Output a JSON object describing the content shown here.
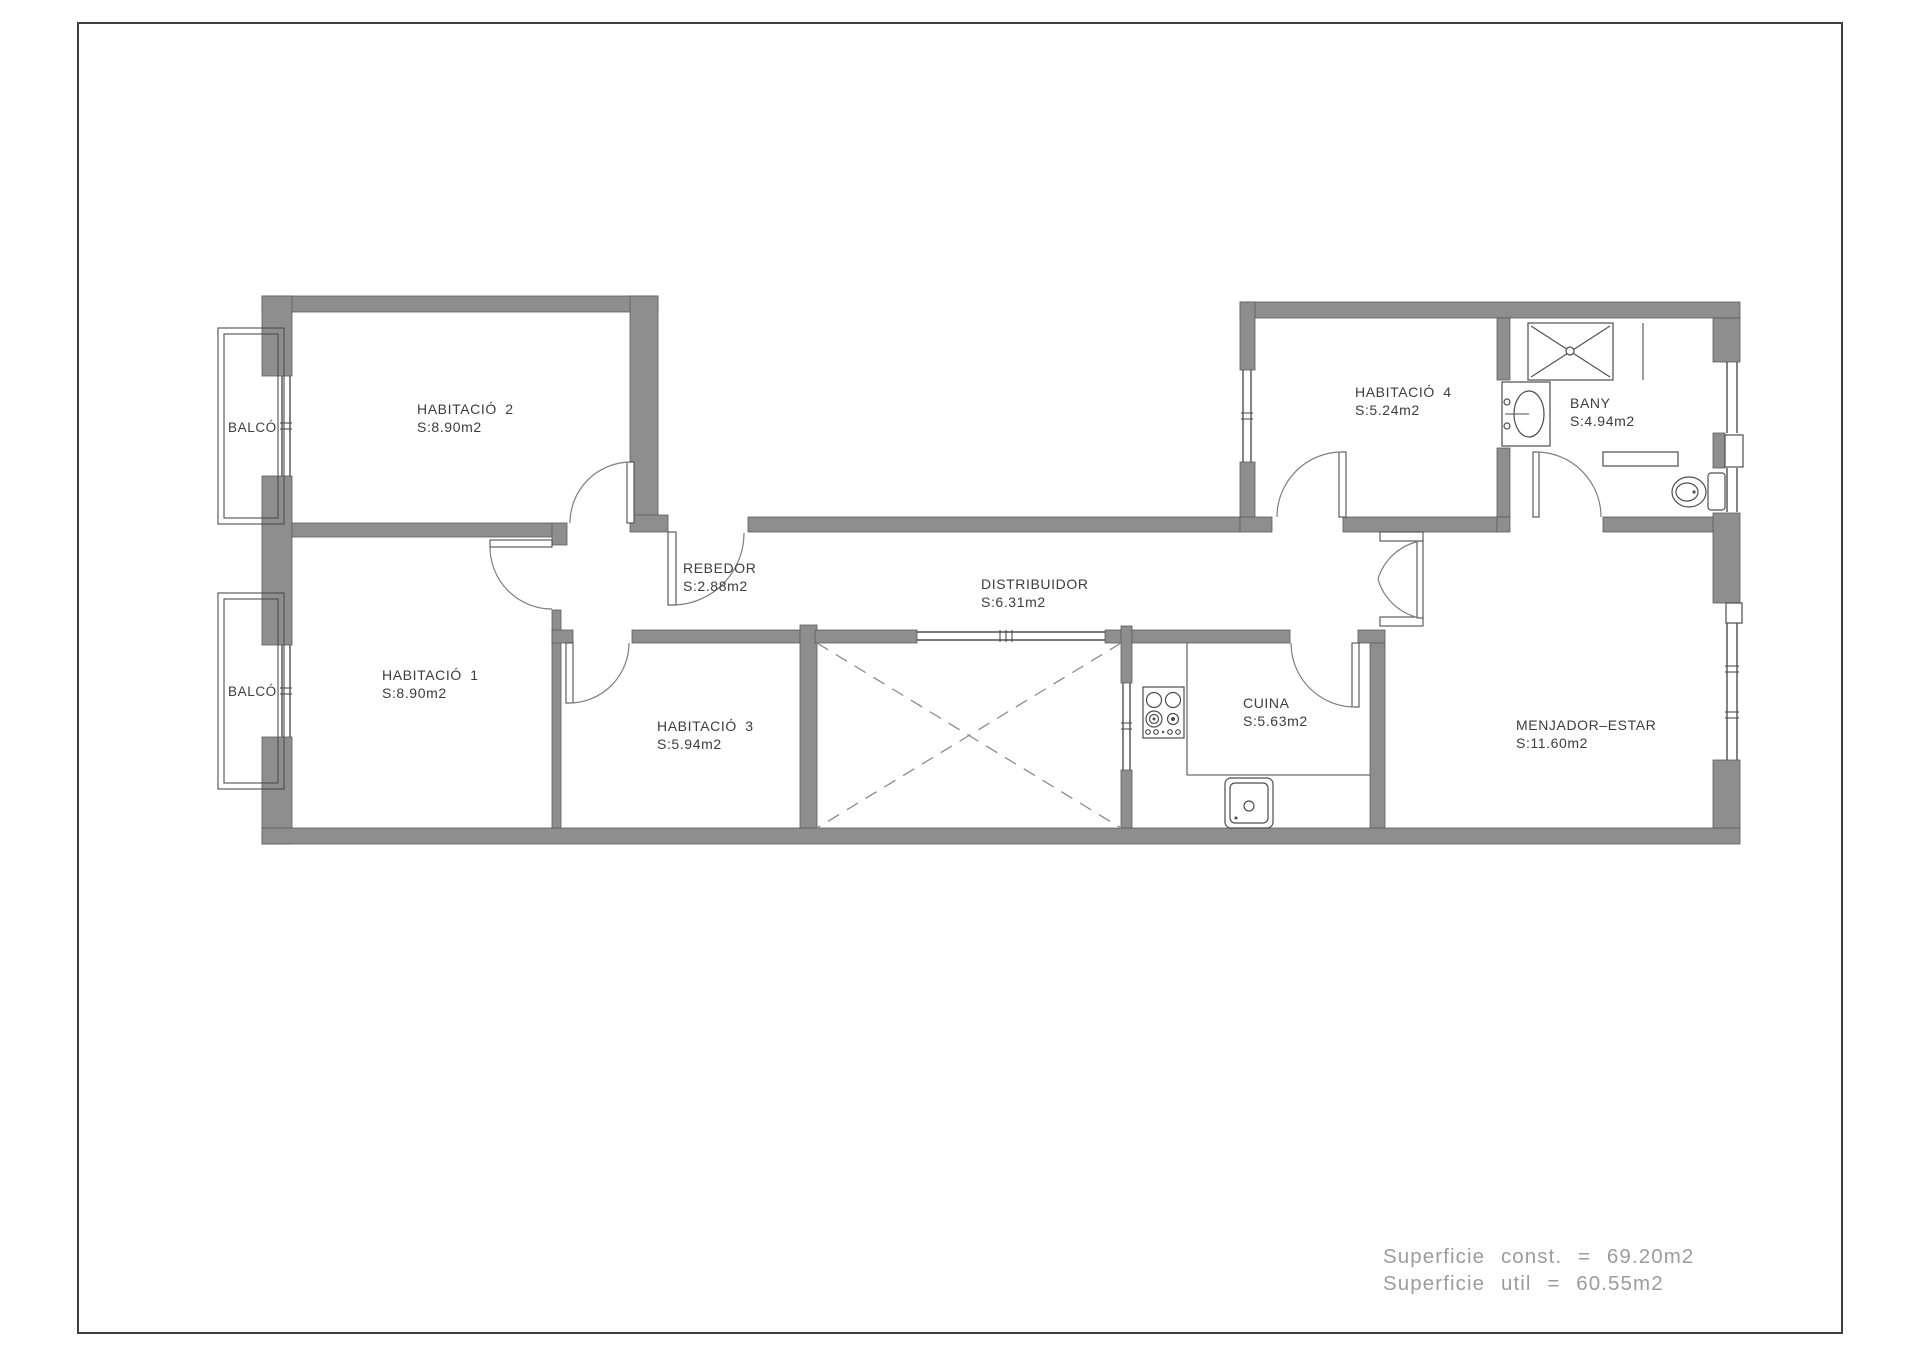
{
  "plan": {
    "rooms": {
      "habitacio2": {
        "name": "HABITACIÓ 2",
        "area": "S:8.90m2"
      },
      "habitacio1": {
        "name": "HABITACIÓ 1",
        "area": "S:8.90m2"
      },
      "habitacio3": {
        "name": "HABITACIÓ 3",
        "area": "S:5.94m2"
      },
      "habitacio4": {
        "name": "HABITACIÓ 4",
        "area": "S:5.24m2"
      },
      "rebedor": {
        "name": "REBEDOR",
        "area": "S:2.88m2"
      },
      "distribuidor": {
        "name": "DISTRIBUIDOR",
        "area": "S:6.31m2"
      },
      "bany": {
        "name": "BANY",
        "area": "S:4.94m2"
      },
      "cuina": {
        "name": "CUINA",
        "area": "S:5.63m2"
      },
      "menjador": {
        "name": "MENJADOR–ESTAR",
        "area": "S:11.60m2"
      }
    },
    "balconies": {
      "balco1": {
        "label": "BALCÓ"
      },
      "balco2": {
        "label": "BALCÓ"
      }
    },
    "summary": {
      "line1": "Superficie const. = 69.20m2",
      "line2": "Superficie util = 60.55m2"
    },
    "colors": {
      "wall": "#8e8e8e",
      "wall_outline": "#5c5c5c",
      "line": "#4e4e4e",
      "label": "#3d3d3d",
      "summary": "#9c9c9c",
      "border": "#3f3f3f"
    }
  }
}
